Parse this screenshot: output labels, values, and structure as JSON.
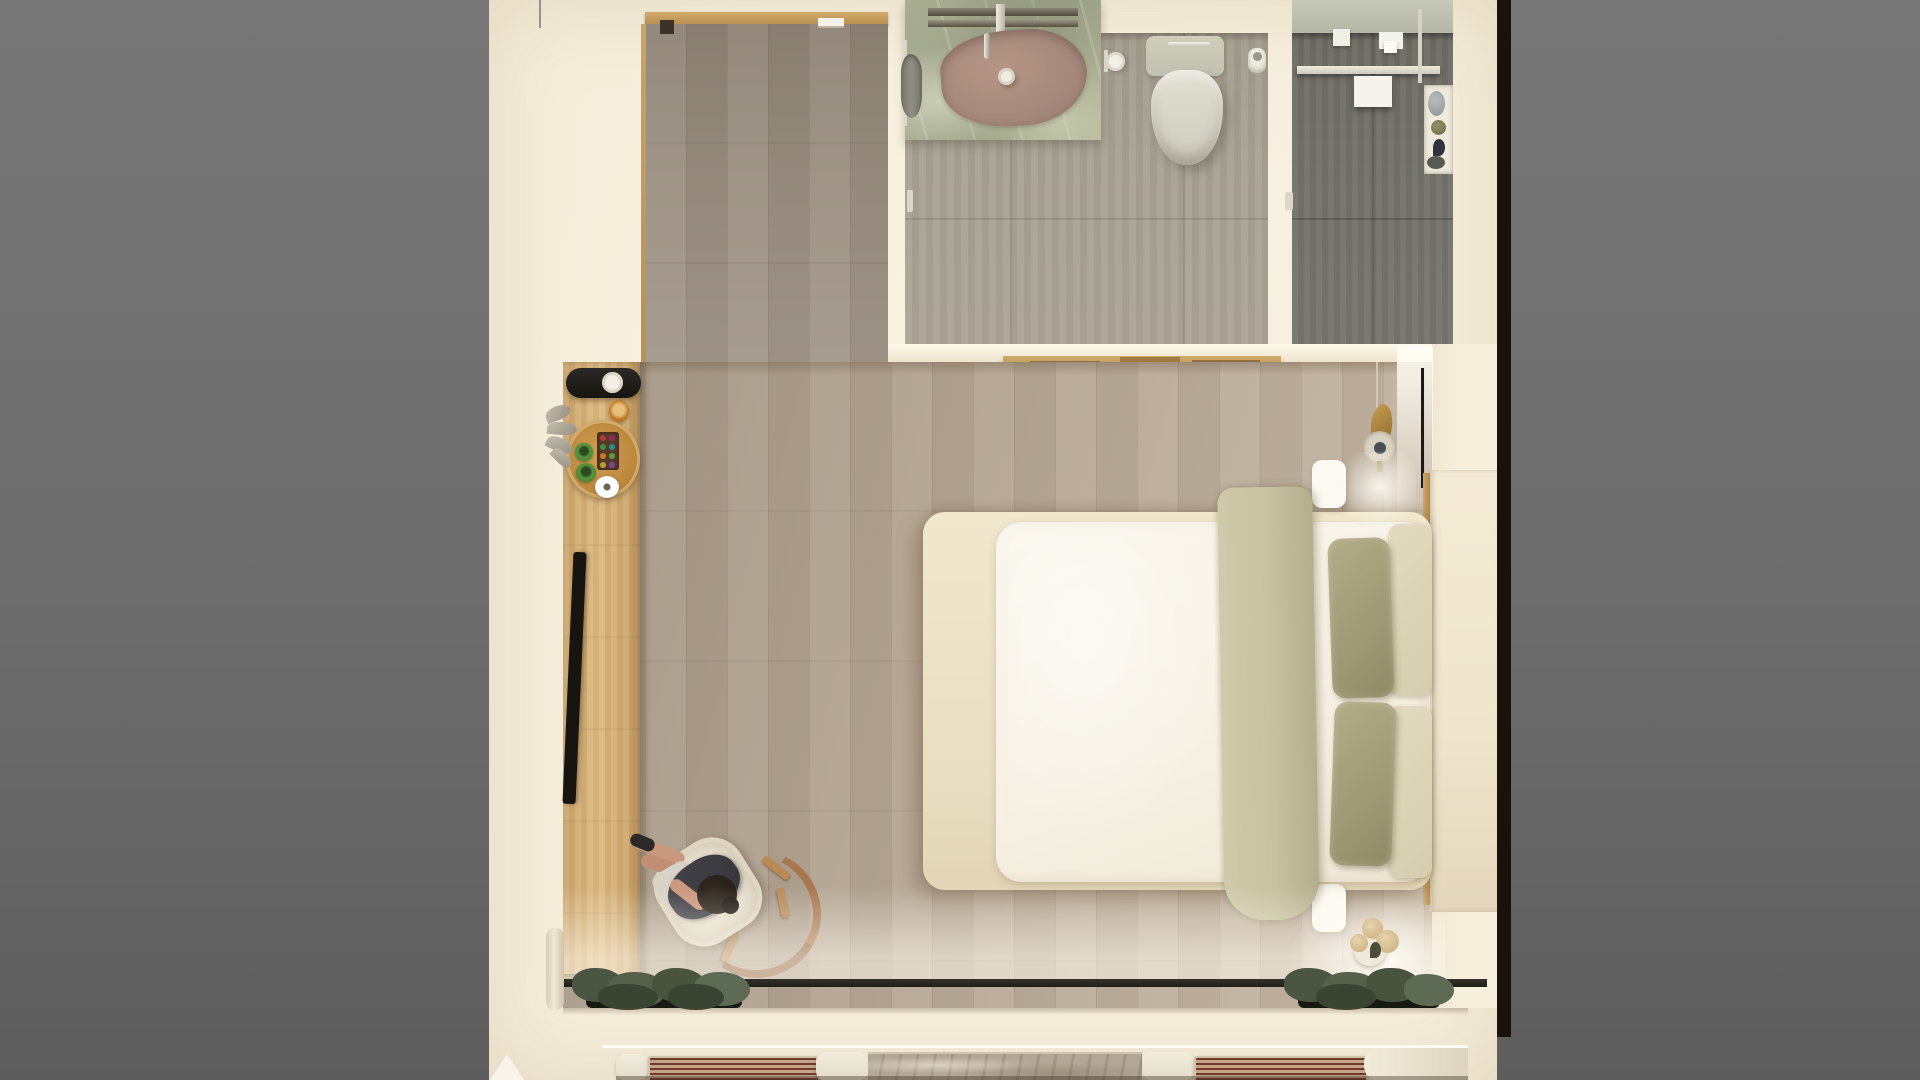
{
  "scene": {
    "title": "Top-down 3D render of a studio bedroom suite with en-suite bathroom and walk-in shower",
    "areas": {
      "canvas_left": "Empty gray canvas (left)",
      "canvas_right": "Empty gray canvas (right)",
      "apartment": "Apartment floor-plan render (cream shell)",
      "dark_strip": "Dark wall edge on right side"
    },
    "rooms": {
      "entry_corridor": "Entry corridor with plank floor",
      "bathroom": "Bathroom with stone vanity and wall-hung toilet",
      "shower_room": "Walk-in shower room with dark tile",
      "bedroom": "Bedroom with double bed and window wall"
    },
    "fixtures": {
      "threshold": "Entry door threshold",
      "door_stopper": "Door stopper block",
      "door_latch": "Door latch plate",
      "vanity": "Green-stone vanity counter",
      "basin": "Pebble-shaped taupe basin",
      "faucet": "Chrome faucet",
      "drain": "Basin drain",
      "mirror": "Mirror and ledge above vanity",
      "towel": "Gray hand towel on rail",
      "toilet": "Wall-hung toilet",
      "toilet_flush": "Chrome flush plate",
      "tp_holder": "Toilet paper holder",
      "toilet_brush": "Toilet brush cup",
      "shower_ledge": "Shower curb ledge",
      "shower_mixer": "Shower mixer controls",
      "shower_towel_bar": "Towel bar",
      "shower_rail": "Shower slide rail",
      "shower_head": "Shower head panel",
      "shower_niche": "Wall niche with toiletries",
      "shower_hinge": "Glass door hinge",
      "wall_shelf": "Wood wall shelf with trays",
      "window": "Window wall frame",
      "window_planter_left": "Planter with foliage (left)",
      "window_planter_right": "Planter with foliage (right)",
      "sill_marble": "Marble sill section",
      "louver_left": "Louvered vent panel (left)",
      "louver_right": "Louvered vent panel (right)"
    },
    "furniture": {
      "sideboard": "Light-wood sideboard console",
      "coffee_machine": "Black coffee machine with white cup",
      "amber_cup": "Amber latte cup",
      "tray": "Round wood serving tray",
      "green_mugs": "Two green mugs",
      "capsule_box": "Box of coffee capsules",
      "flower_dish": "White flower-shaped dish",
      "silver_plant": "Silver decorative foliage",
      "tv": "Flat TV standing on sideboard",
      "bed": "Double bed",
      "bed_platform": "Cream bed platform",
      "mattress": "White duvet and mattress",
      "throw": "Sage throw runner",
      "pillow_olive_top": "Olive pillow (upper)",
      "pillow_olive_bottom": "Olive pillow (lower)",
      "pillow_cream_top": "Cream pillow (upper)",
      "pillow_cream_bottom": "Cream pillow (lower)",
      "nightstand_top": "Bedside ledge (upper)",
      "nightstand_bottom": "Bedside ledge (lower)",
      "headboard": "Headboard panel against right wall",
      "pendant": "Hanging wall decor with disc",
      "armchair": "Boucle armchair with wood frame",
      "person": "Person seated in armchair",
      "decor_balls": "Dried-flower decor in vase"
    },
    "palette_note": "Colors sampled from render"
  },
  "palette": {
    "bg_gray_top": "#767676",
    "bg_gray": "#6d6d6d",
    "bg_gray_bottom": "#5d5d5d",
    "wall_cream": "#f5eedb",
    "dark_strip": "#18110c",
    "chrome": "#d9d6ca",
    "tv_black": "#17150f",
    "corridor_floor": "#9a8f81",
    "bedroom_floor": "#b4a593",
    "bathroom_floor": "#a8a295",
    "shower_floor": "#73736c",
    "vanity_stone": "#a6ab91",
    "basin_taupe": "#ad9080",
    "gold_wood": "#c9a267",
    "sideboard_wood": "#d3ad74",
    "bed_platform": "#eee4ca",
    "duvet_white": "#f9f5eb",
    "throw_sage": "#c8c3a1",
    "pillow_olive": "#a8a27d",
    "pillow_cream": "#dcd5b7",
    "plant_sage": "#55614b",
    "plant_dark": "#394433",
    "window_bar": "#26261f",
    "sill_marble": "#b3a797",
    "louver_brown": "#6e3b2b"
  }
}
